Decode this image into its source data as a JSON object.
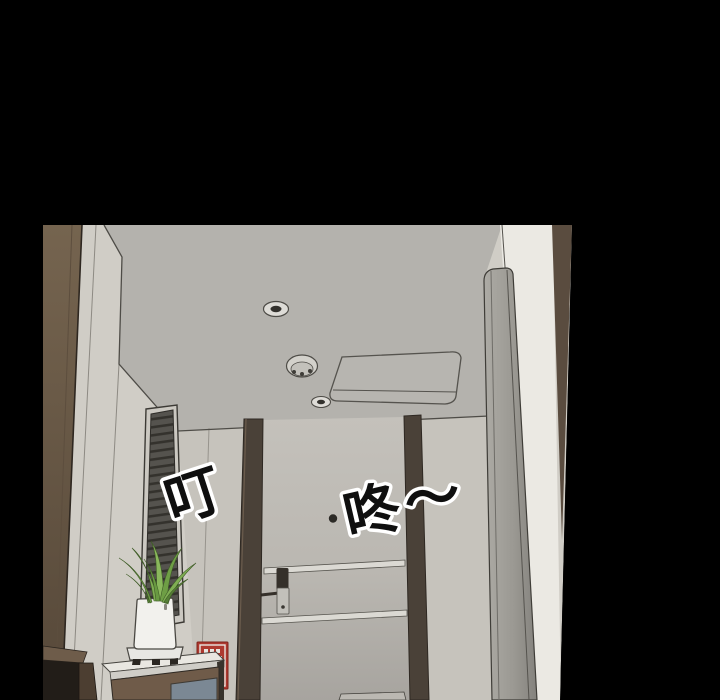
{
  "panel": {
    "type": "webtoon-comic-panel",
    "background": "#000000",
    "sfx": {
      "ding": "叮",
      "dong": "咚～"
    },
    "objects": [
      "hallway-ceiling",
      "recessed-light",
      "smoke-detector",
      "ac-vent",
      "window-blinds",
      "potted-plant",
      "planter-tray",
      "entry-door",
      "door-lock",
      "door-peephole",
      "door-frame-posts",
      "open-door-panel",
      "white-wall",
      "fire-extinguisher-sign",
      "counter",
      "cabinet-blue-panel",
      "wood-ledge"
    ],
    "palette": {
      "bg": "#000000",
      "wall": "#d0cdc6",
      "wall_front": "#c6c3bc",
      "ceiling": "#b4b2ad",
      "trim_left_top": "#75644f",
      "trim_left_bottom": "#564839",
      "post": "#4a4138",
      "door_top": "#c4c1bb",
      "door_bottom": "#a7a49f",
      "door_seam": "#dbd9d3",
      "blinds": "#55534e",
      "blind_slat": "#34322d",
      "white_wall": "#ebe9e3",
      "side_panel_light": "#adaba5",
      "side_panel_dark": "#8f8d88",
      "sliver_brown": "#5a4c3f",
      "vent": "#b7b5b0",
      "fixture_light": "#dedcd7",
      "fixture_dark": "#33312d",
      "plant": "#7fae53",
      "plant_mid": "#6e9e45",
      "plant_dark": "#567f36",
      "pot": "#f2f1ed",
      "tray": "#e8e7e3",
      "pebbles": "#2b2722",
      "sign_red": "#ae392f",
      "sign_white": "#e9e6e0",
      "counter_top": "#e9e7e1",
      "counter_edge": "#cfcdc7",
      "cabinet": "#6f5b49",
      "panel_blue": "#7b8894",
      "ledge_top": "#6e5c4a",
      "ledge_dark": "#221d18",
      "ledge_leg": "#4c3e31",
      "line": "#4e4c47",
      "lock_dark": "#35302a",
      "lock_light": "#c2c0ba",
      "peephole": "#2c2a26",
      "threshold": "#bbb8b2",
      "sfx_fill": "#0f0f0f",
      "sfx_stroke": "#ffffff"
    }
  }
}
